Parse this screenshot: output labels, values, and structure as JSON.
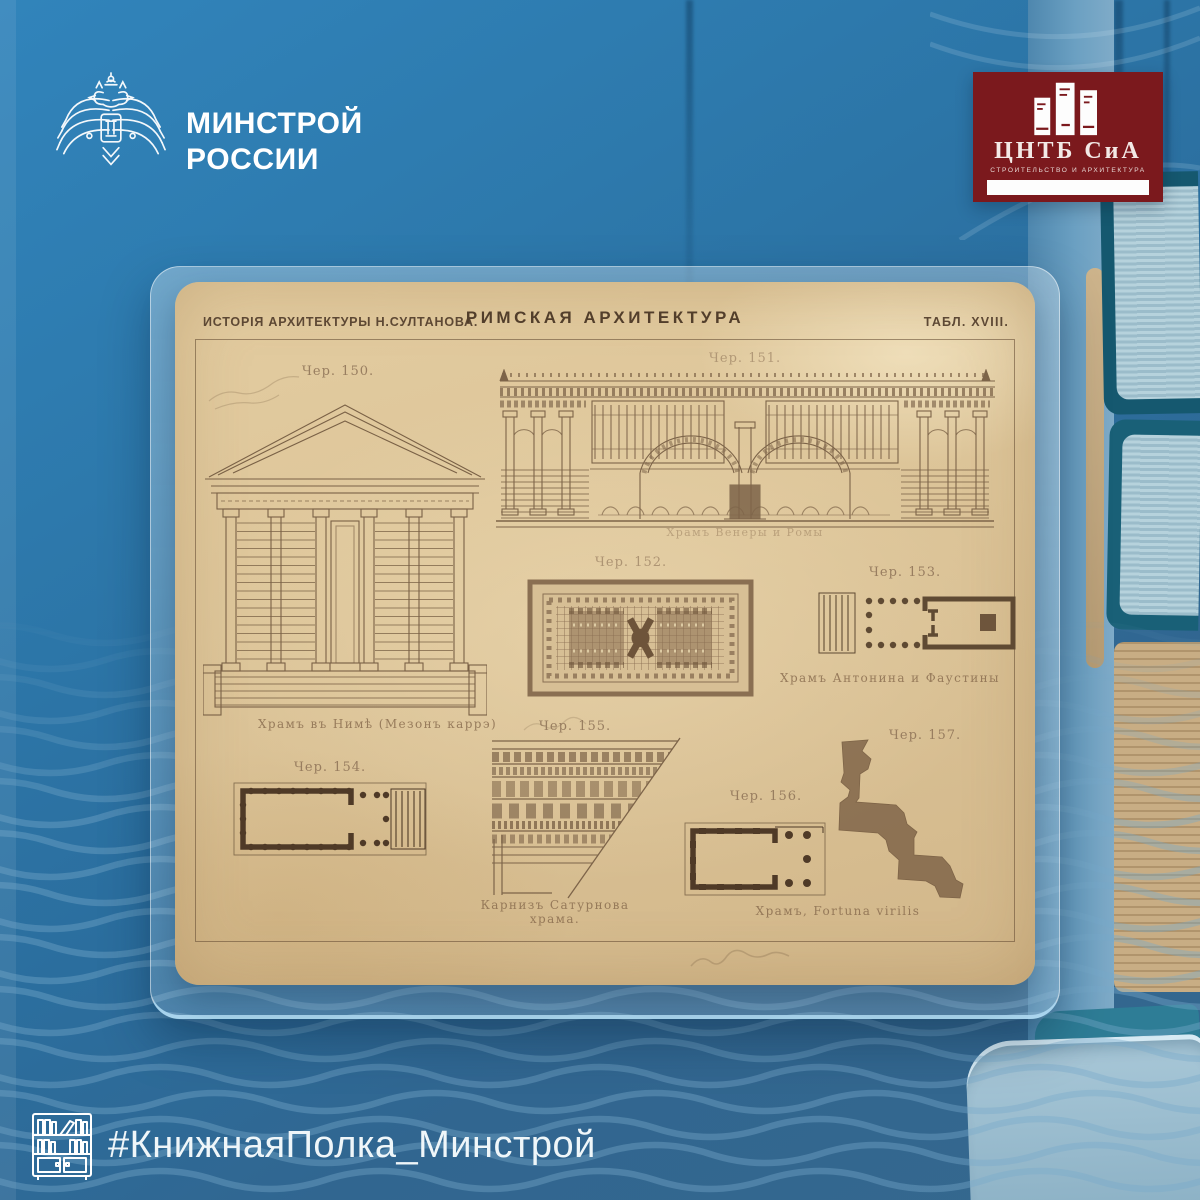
{
  "brand": {
    "minstroy_line1": "МИНСТРОЙ",
    "minstroy_line2": "РОССИИ"
  },
  "cntb_logo": {
    "title": "ЦНТБ СиА",
    "subtitle": "СТРОИТЕЛЬСТВО И АРХИТЕКТУРА"
  },
  "plate": {
    "source_title": "ИСТОРІЯ АРХИТЕКТУРЫ Н.СУЛТАНОВА.",
    "main_title": "РИМСКАЯ АРХИТЕКТУРА",
    "table_label": "ТАБЛ. XVIII.",
    "figures": [
      {
        "id": "150",
        "label": "Чер. 150.",
        "caption": "Храмъ въ Нимѣ (Мезонъ каррэ)",
        "type": "temple-front-elevation"
      },
      {
        "id": "151",
        "label": "Чер. 151.",
        "caption": "Храмъ Венеры и Ромы",
        "type": "temple-section"
      },
      {
        "id": "152",
        "label": "Чер. 152.",
        "caption": "",
        "type": "mosaic-floor-plan"
      },
      {
        "id": "153",
        "label": "Чер. 153.",
        "caption": "Храмъ Антонина и Фаустины",
        "type": "temple-plan"
      },
      {
        "id": "154",
        "label": "Чер. 154.",
        "caption": "",
        "type": "temple-plan"
      },
      {
        "id": "155",
        "label": "Чер. 155.",
        "caption": "Карнизъ Сатурнова храма.",
        "type": "cornice-detail"
      },
      {
        "id": "156",
        "label": "Чер. 156.",
        "caption": "Храмъ, Fortuna virilis",
        "type": "temple-plan"
      },
      {
        "id": "157",
        "label": "Чер. 157.",
        "caption": "",
        "type": "moulding-profile"
      }
    ]
  },
  "footer": {
    "hashtag": "#КнижнаяПолка_Минстрой"
  },
  "icons": {
    "emblem": "double-headed-eagle",
    "cntb_books": "stacked-books",
    "footer_shelf": "bookshelf"
  },
  "colors": {
    "background_blue": "#2e76a9",
    "card_tint": "rgba(235,244,250,0.28)",
    "plate_paper": "#ddc69c",
    "ink_brown": "#6f583f",
    "logo_maroon": "#7b191d",
    "text_white": "#f4f8fa"
  }
}
